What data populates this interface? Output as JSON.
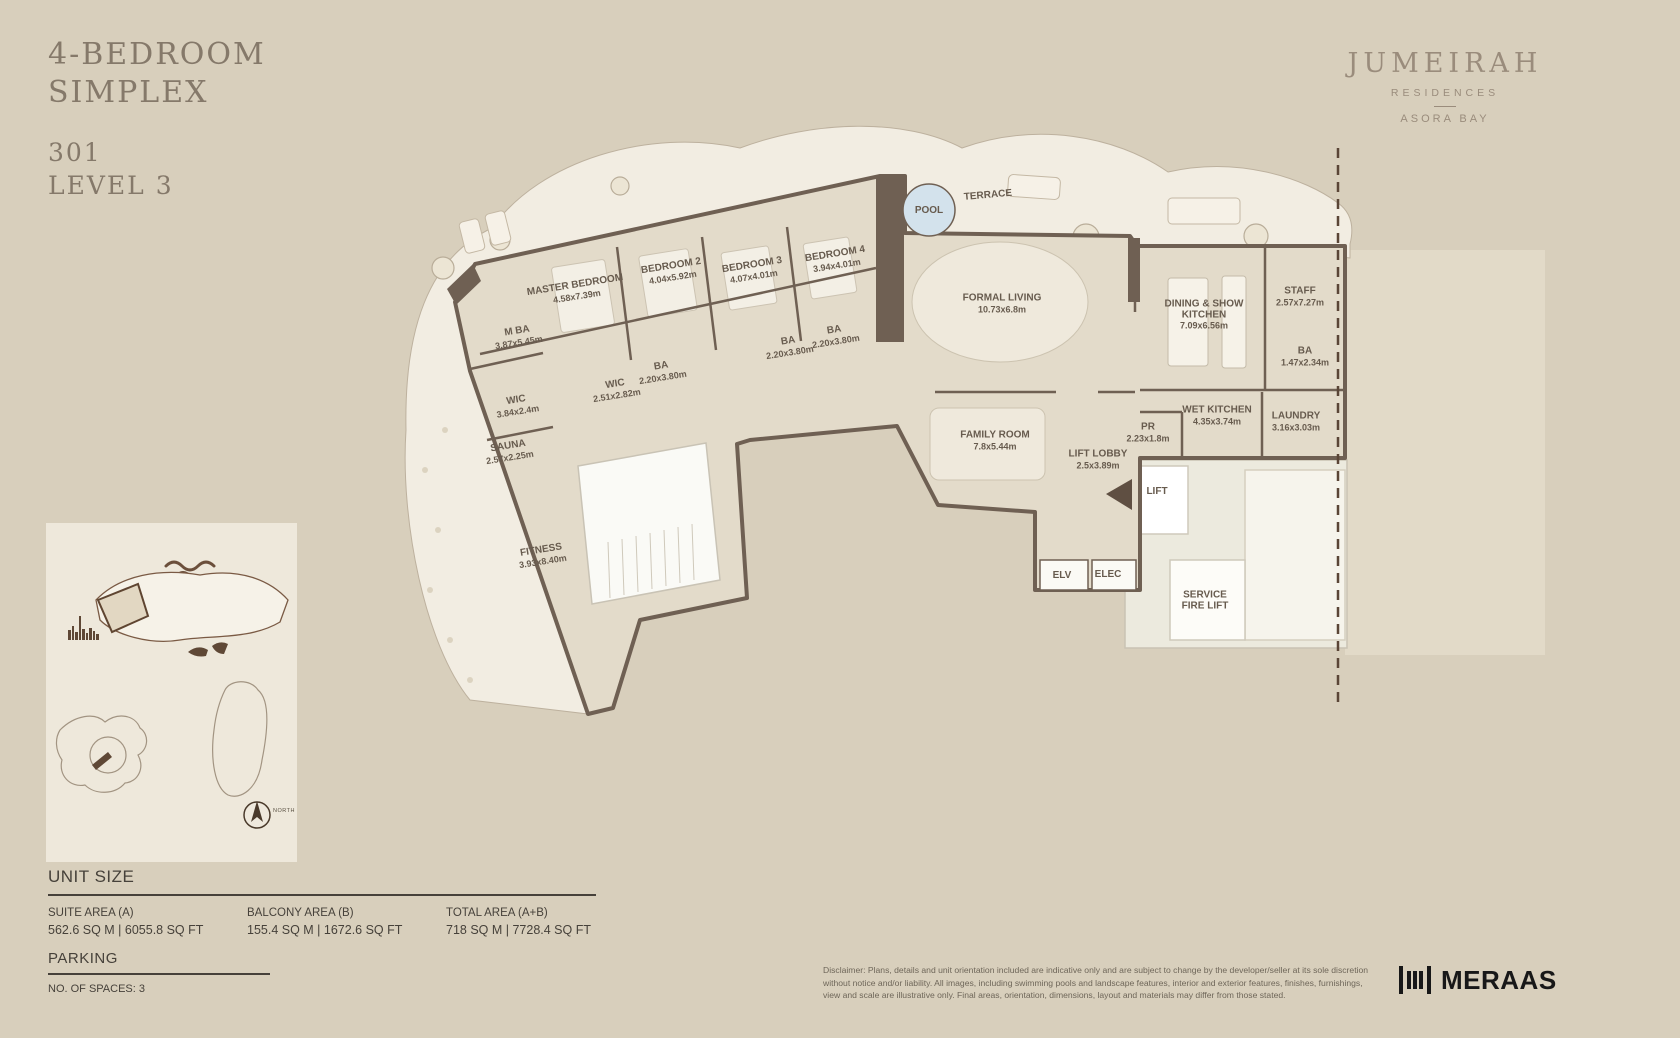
{
  "header": {
    "title_line1": "4-BEDROOM",
    "title_line2": "SIMPLEX",
    "unit_number": "301",
    "level": "LEVEL 3"
  },
  "brand": {
    "name": "JUMEIRAH",
    "sub": "RESIDENCES",
    "location": "ASORA BAY"
  },
  "plan": {
    "rooms": [
      {
        "name": "MASTER BEDROOM",
        "dims": "4.58x7.39m",
        "x": 576,
        "y": 291,
        "rot": -9
      },
      {
        "name": "BEDROOM 2",
        "dims": "4.04x5.92m",
        "x": 672,
        "y": 272,
        "rot": -9
      },
      {
        "name": "BEDROOM 3",
        "dims": "4.07x4.01m",
        "x": 753,
        "y": 271,
        "rot": -9
      },
      {
        "name": "BEDROOM 4",
        "dims": "3.94x4.01m",
        "x": 836,
        "y": 260,
        "rot": -9
      },
      {
        "name": "M BA",
        "dims": "3.87x5.45m",
        "x": 518,
        "y": 337,
        "rot": -9
      },
      {
        "name": "WIC",
        "dims": "3.84x2.4m",
        "x": 517,
        "y": 406,
        "rot": -9
      },
      {
        "name": "WIC",
        "dims": "2.51x2.82m",
        "x": 616,
        "y": 390,
        "rot": -9
      },
      {
        "name": "BA",
        "dims": "2.20x3.80m",
        "x": 662,
        "y": 372,
        "rot": -9
      },
      {
        "name": "BA",
        "dims": "2.20x3.80m",
        "x": 789,
        "y": 347,
        "rot": -9
      },
      {
        "name": "BA",
        "dims": "2.20x3.80m",
        "x": 835,
        "y": 336,
        "rot": -9
      },
      {
        "name": "SAUNA",
        "dims": "2.57x2.25m",
        "x": 509,
        "y": 452,
        "rot": -9
      },
      {
        "name": "FITNESS",
        "dims": "3.93x8.40m",
        "x": 542,
        "y": 556,
        "rot": -9
      },
      {
        "name": "FORMAL LIVING",
        "dims": "10.73x6.8m",
        "x": 1002,
        "y": 304,
        "rot": 0
      },
      {
        "name": "FAMILY ROOM",
        "dims": "7.8x5.44m",
        "x": 995,
        "y": 441,
        "rot": 0
      },
      {
        "name": "LIFT LOBBY",
        "dims": "2.5x3.89m",
        "x": 1098,
        "y": 460,
        "rot": 0
      },
      {
        "name": "PR",
        "dims": "2.23x1.8m",
        "x": 1148,
        "y": 433,
        "rot": 0
      },
      {
        "name": "DINING & SHOW KITCHEN",
        "dims": "7.09x6.56m",
        "x": 1204,
        "y": 315,
        "rot": 0,
        "w": 112
      },
      {
        "name": "STAFF",
        "dims": "2.57x7.27m",
        "x": 1300,
        "y": 297,
        "rot": 0
      },
      {
        "name": "BA",
        "dims": "1.47x2.34m",
        "x": 1305,
        "y": 357,
        "rot": 0
      },
      {
        "name": "WET KITCHEN",
        "dims": "4.35x3.74m",
        "x": 1217,
        "y": 416,
        "rot": 0
      },
      {
        "name": "LAUNDRY",
        "dims": "3.16x3.03m",
        "x": 1296,
        "y": 422,
        "rot": 0
      },
      {
        "name": "POOL",
        "dims": "",
        "x": 929,
        "y": 211,
        "rot": 0
      },
      {
        "name": "TERRACE",
        "dims": "",
        "x": 988,
        "y": 196,
        "rot": -5
      },
      {
        "name": "LIFT",
        "dims": "",
        "x": 1157,
        "y": 492,
        "rot": 0
      },
      {
        "name": "ELV",
        "dims": "",
        "x": 1062,
        "y": 576,
        "rot": 0
      },
      {
        "name": "ELEC",
        "dims": "",
        "x": 1108,
        "y": 575,
        "rot": 0
      },
      {
        "name": "SERVICE FIRE LIFT",
        "dims": "",
        "x": 1205,
        "y": 601,
        "rot": 0,
        "w": 64
      }
    ]
  },
  "keyplan": {
    "north_label": "NORTH"
  },
  "unit_size": {
    "heading": "UNIT SIZE",
    "columns": [
      {
        "label": "SUITE AREA (A)",
        "value": "562.6 SQ M | 6055.8 SQ FT"
      },
      {
        "label": "BALCONY AREA (B)",
        "value": "155.4 SQ M | 1672.6 SQ FT"
      },
      {
        "label": "TOTAL AREA (A+B)",
        "value": "718 SQ M | 7728.4 SQ FT"
      }
    ]
  },
  "parking": {
    "heading": "PARKING",
    "value": "NO. OF SPACES: 3"
  },
  "disclaimer": {
    "text": "Disclaimer: Plans, details and unit orientation included are indicative only and are subject to change by the developer/seller at its sole discretion without notice and/or liability. All images, including swimming pools and landscape features, interior and exterior features, finishes, furnishings, view and scale are illustrative only. Final areas, orientation, dimensions, layout and materials may differ from those stated."
  },
  "footer": {
    "brand": "MERAAS"
  }
}
